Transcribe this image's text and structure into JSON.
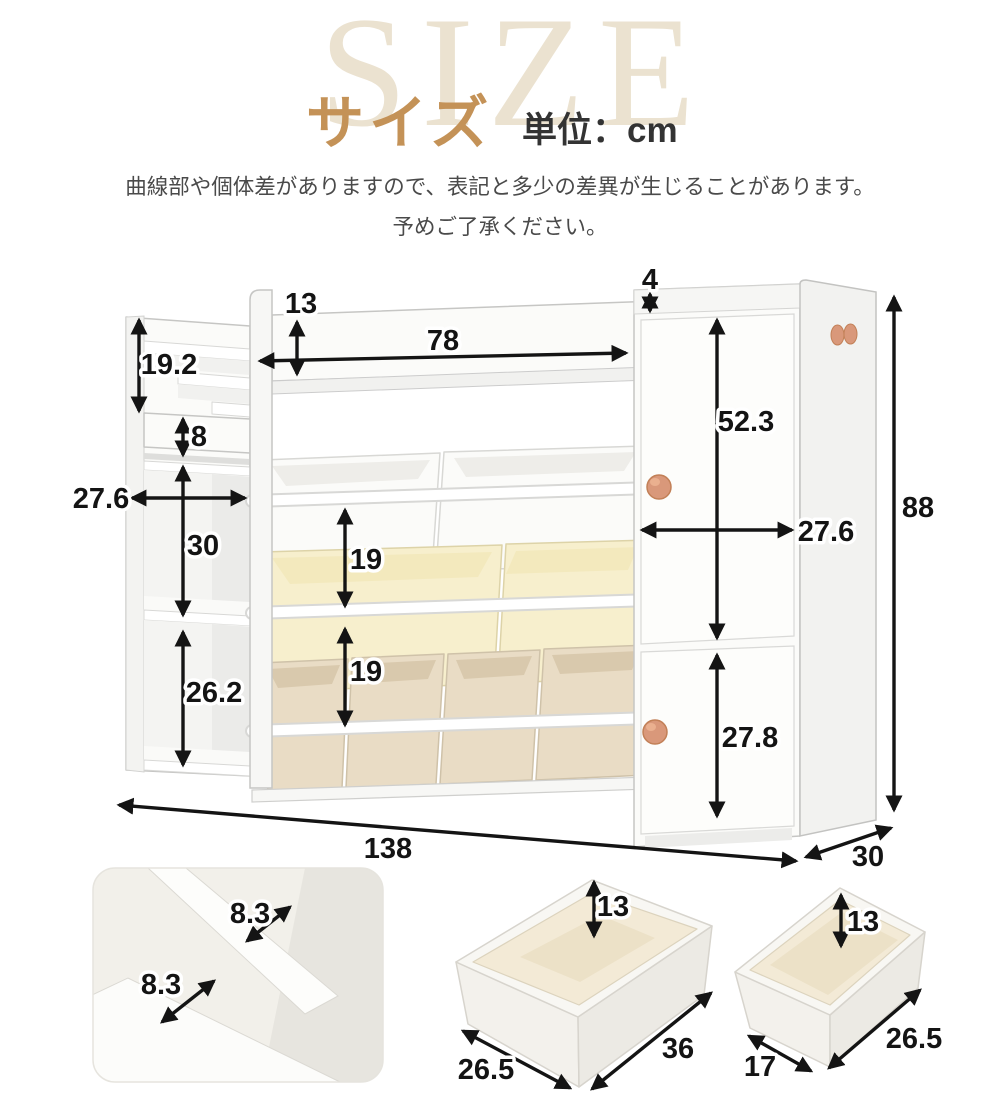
{
  "header": {
    "size_en": "SIZE",
    "size_ja": "サイズ",
    "unit_label": "単位：cm"
  },
  "disclaimer": {
    "line1": "曲線部や個体差がありますので、表記と多少の差異が生じることがあります。",
    "line2": "予めご了承ください。"
  },
  "colors": {
    "accent_tan": "#c49257",
    "size_watermark": "#ebe2d0",
    "dimension_text": "#141414",
    "knob": "#d9987a",
    "bin_white": "#fbfbf9",
    "bin_cream": "#f7efcd",
    "bin_beige": "#e9dcc5"
  },
  "main_diagram": {
    "unit": "cm",
    "dim": {
      "back_panel_height": "13",
      "top_shelf_width": "78",
      "cabinet_top_edge": "4",
      "rack_display_height": "19.2",
      "rack_slot_height": "8",
      "rack_width": "27.6",
      "rack_upper_compartment": "30",
      "rack_lower_compartment": "26.2",
      "row_gap_upper": "19",
      "row_gap_lower": "19",
      "upper_door_height": "52.3",
      "cabinet_width": "27.6",
      "lower_door_height": "27.8",
      "overall_height": "88",
      "overall_width": "138",
      "overall_depth": "30"
    }
  },
  "details": {
    "rack_closeup": {
      "slot_depth_a": "8.3",
      "slot_depth_b": "8.3"
    },
    "large_bin": {
      "height": "13",
      "length": "36",
      "width": "26.5"
    },
    "small_bin": {
      "height": "13",
      "length": "26.5",
      "width": "17"
    }
  }
}
